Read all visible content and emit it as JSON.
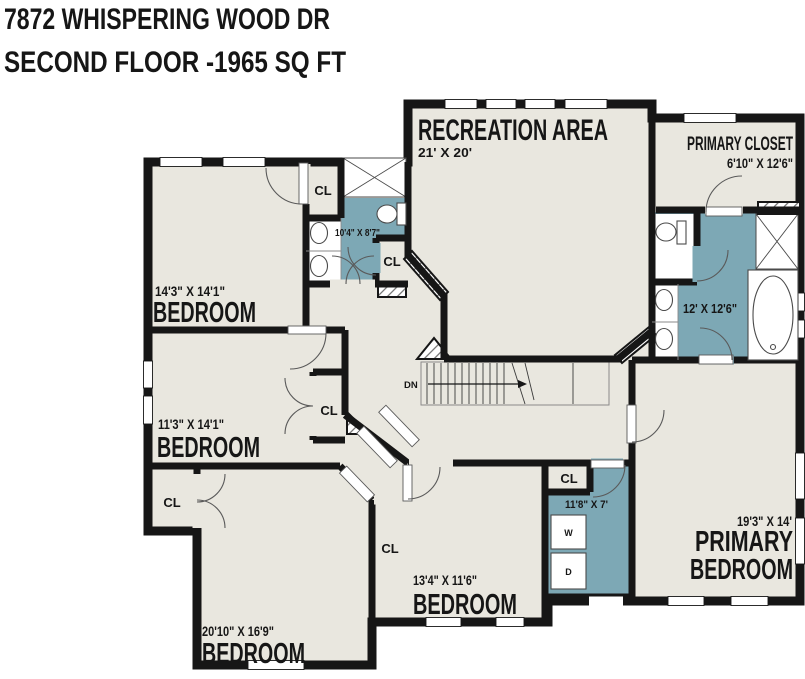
{
  "title": {
    "line1": "7872 WHISPERING WOOD DR",
    "line2": "SECOND FLOOR -1965 SQ FT"
  },
  "rooms": {
    "recreation": {
      "name": "RECREATION AREA",
      "dims": "21' X 20'"
    },
    "primary_closet": {
      "name": "PRIMARY CLOSET",
      "dims": "6'10\" X 12'6\""
    },
    "bedroom1": {
      "name": "BEDROOM",
      "dims": "14'3\" X 14'1\""
    },
    "bedroom2": {
      "name": "BEDROOM",
      "dims": "11'3\" X 14'1\""
    },
    "bedroom3": {
      "name": "BEDROOM",
      "dims": "20'10\" X 16'9\""
    },
    "bedroom4": {
      "name": "BEDROOM",
      "dims": "13'4\" X 11'6\""
    },
    "primary_bedroom": {
      "name_line1": "PRIMARY",
      "name_line2": "BEDROOM",
      "dims": "19'3\" X 14'"
    },
    "hall_bath": {
      "dims": "10'4\" X 8'7\""
    },
    "primary_bath": {
      "dims": "12' X 12'6\""
    },
    "laundry": {
      "dims": "11'8\" X 7'"
    }
  },
  "labels": {
    "closet": "CL",
    "stairs_down": "DN",
    "washer": "W",
    "dryer": "D"
  },
  "colors": {
    "background": "#ffffff",
    "floor": "#e9e7df",
    "wet_room": "#7da8b5",
    "wall": "#161616",
    "fixture_white": "#ffffff"
  }
}
